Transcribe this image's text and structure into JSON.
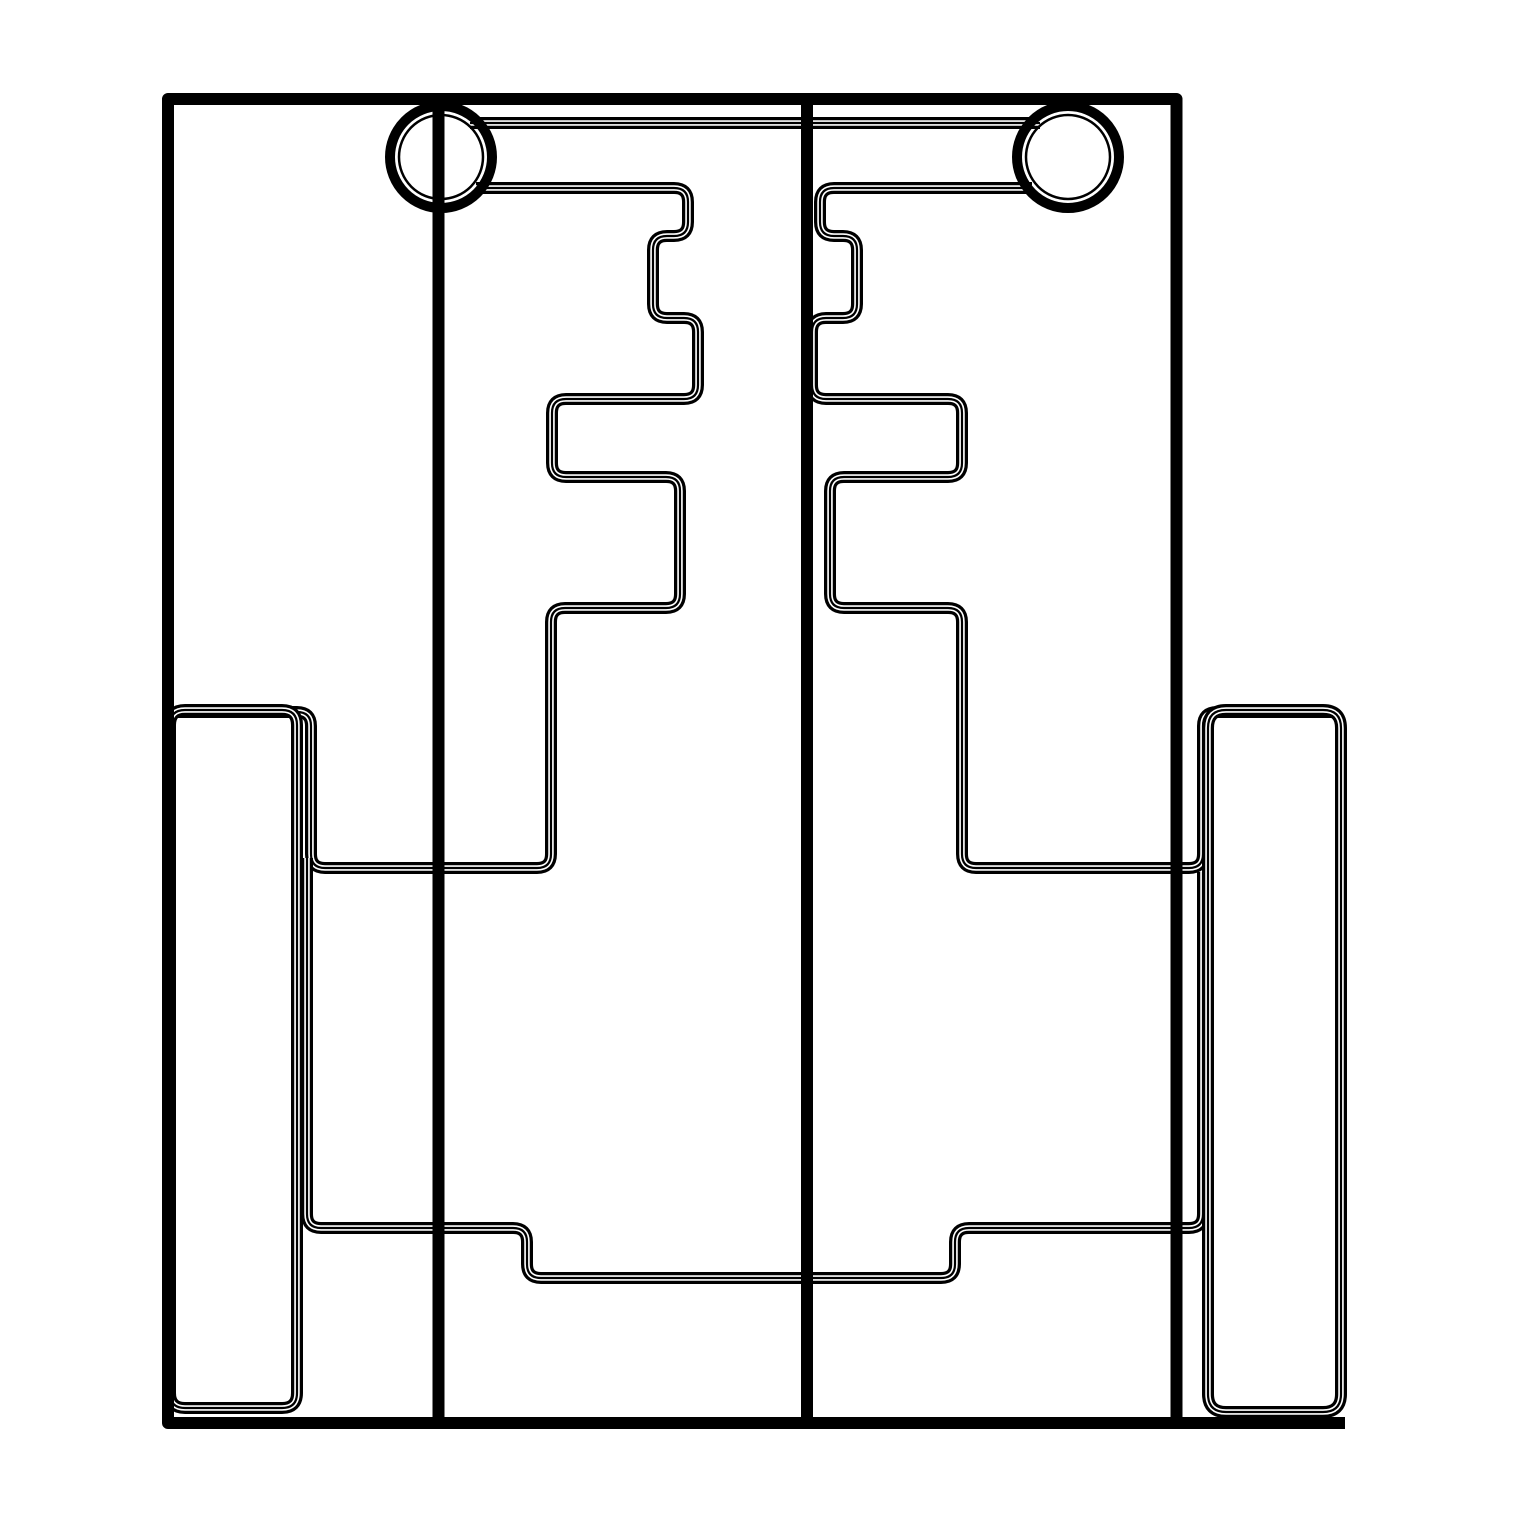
{
  "drawing": {
    "title": "cad-line-drawing",
    "width": 1519,
    "height": 1519,
    "palette": {
      "ink": "#000000",
      "paper": "#ffffff"
    },
    "style": {
      "thick": 12,
      "channel": 5.5,
      "hairline": 2.2,
      "solid": 12,
      "ring_outer_radius": 51,
      "ring_outer_stroke": 10,
      "ring_inner_radius": 42,
      "ring_inner_stroke": 2.5
    },
    "shapes": [
      {
        "name": "axle-bar-top",
        "type": "triple",
        "d": "M 470 123 L 1040 123"
      },
      {
        "name": "left-comb-plate",
        "type": "triple",
        "d": "M 476 188 L 674 188 Q 688 188 688 202 L 688 222 Q 688 236 674 236 L 667 236 Q 653 236 653 250 L 653 304 Q 653 318 667 318 L 684 318 Q 698 318 698 332 L 698 385 Q 698 399 684 399 L 566 399 Q 552 399 552 413 L 552 463 Q 552 477 566 477 L 666 477 Q 680 477 680 491 L 680 594 Q 680 608 666 608 L 565 608 Q 551 608 551 622 L 551 854 Q 551 868 537 868 L 325 868 Q 311 868 311 854 L 311 726 Q 311 712 297 712 L 178 712"
      },
      {
        "name": "right-comb-plate",
        "type": "triple",
        "d": "M 1032 188 L 834 188 Q 820 188 820 202 L 820 222 Q 820 236 834 236 L 843 236 Q 857 236 857 250 L 857 304 Q 857 318 843 318 L 826 318 Q 812 318 812 332 L 812 385 Q 812 399 826 399 L 948 399 Q 962 399 962 413 L 962 463 Q 962 477 948 477 L 844 477 Q 830 477 830 491 L 830 594 Q 830 608 844 608 L 948 608 Q 962 608 962 622 L 962 854 Q 962 868 976 868 L 1189 868 Q 1203 868 1203 854 L 1203 726 Q 1203 712 1217 712 L 1334 712"
      },
      {
        "name": "lower-crossbar",
        "type": "triple",
        "d": "M 307 858 L 307 1214 Q 307 1228 321 1228 L 513 1228 Q 527 1228 527 1242 L 527 1264 Q 527 1278 541 1278 L 941 1278 Q 955 1278 955 1264 L 955 1242 Q 955 1228 969 1228 L 1189 1228 Q 1203 1228 1203 1214 L 1203 872"
      },
      {
        "name": "left-skid",
        "type": "triple",
        "d": "M 185 710 L 282 710 Q 297 710 297 725 L 297 1393 Q 297 1408 282 1408 L 185 1408 Q 170 1408 170 1393 L 170 725 Q 170 710 185 710 Z"
      },
      {
        "name": "right-skid",
        "type": "triple",
        "d": "M 1226 710 L 1323 710 Q 1341 710 1341 728 L 1341 1394 Q 1341 1412 1323 1412 L 1226 1412 Q 1208 1412 1208 1394 L 1208 728 Q 1208 710 1226 710 Z"
      },
      {
        "name": "left-wheel",
        "type": "ring",
        "cx": 441,
        "cy": 157
      },
      {
        "name": "right-wheel",
        "type": "ring",
        "cx": 1068,
        "cy": 157
      },
      {
        "name": "left-axle-line",
        "type": "solid",
        "d": "M 438.5 99 L 438.5 1417"
      },
      {
        "name": "center-divider-line",
        "type": "solid",
        "d": "M 807 99 L 807 1417"
      },
      {
        "name": "outer-frame",
        "type": "solid",
        "d": "M 168 99 L 1176.5 99 L 1176.5 1423 L 168 1423 Z"
      },
      {
        "name": "frame-bottom-extension",
        "type": "solid",
        "d": "M 1176 1423 L 1345 1423"
      },
      {
        "name": "corner-flag",
        "type": "fill",
        "d": "M 1170 93 L 1344 93 L 1344 369 L 1170 369 Z"
      }
    ]
  }
}
